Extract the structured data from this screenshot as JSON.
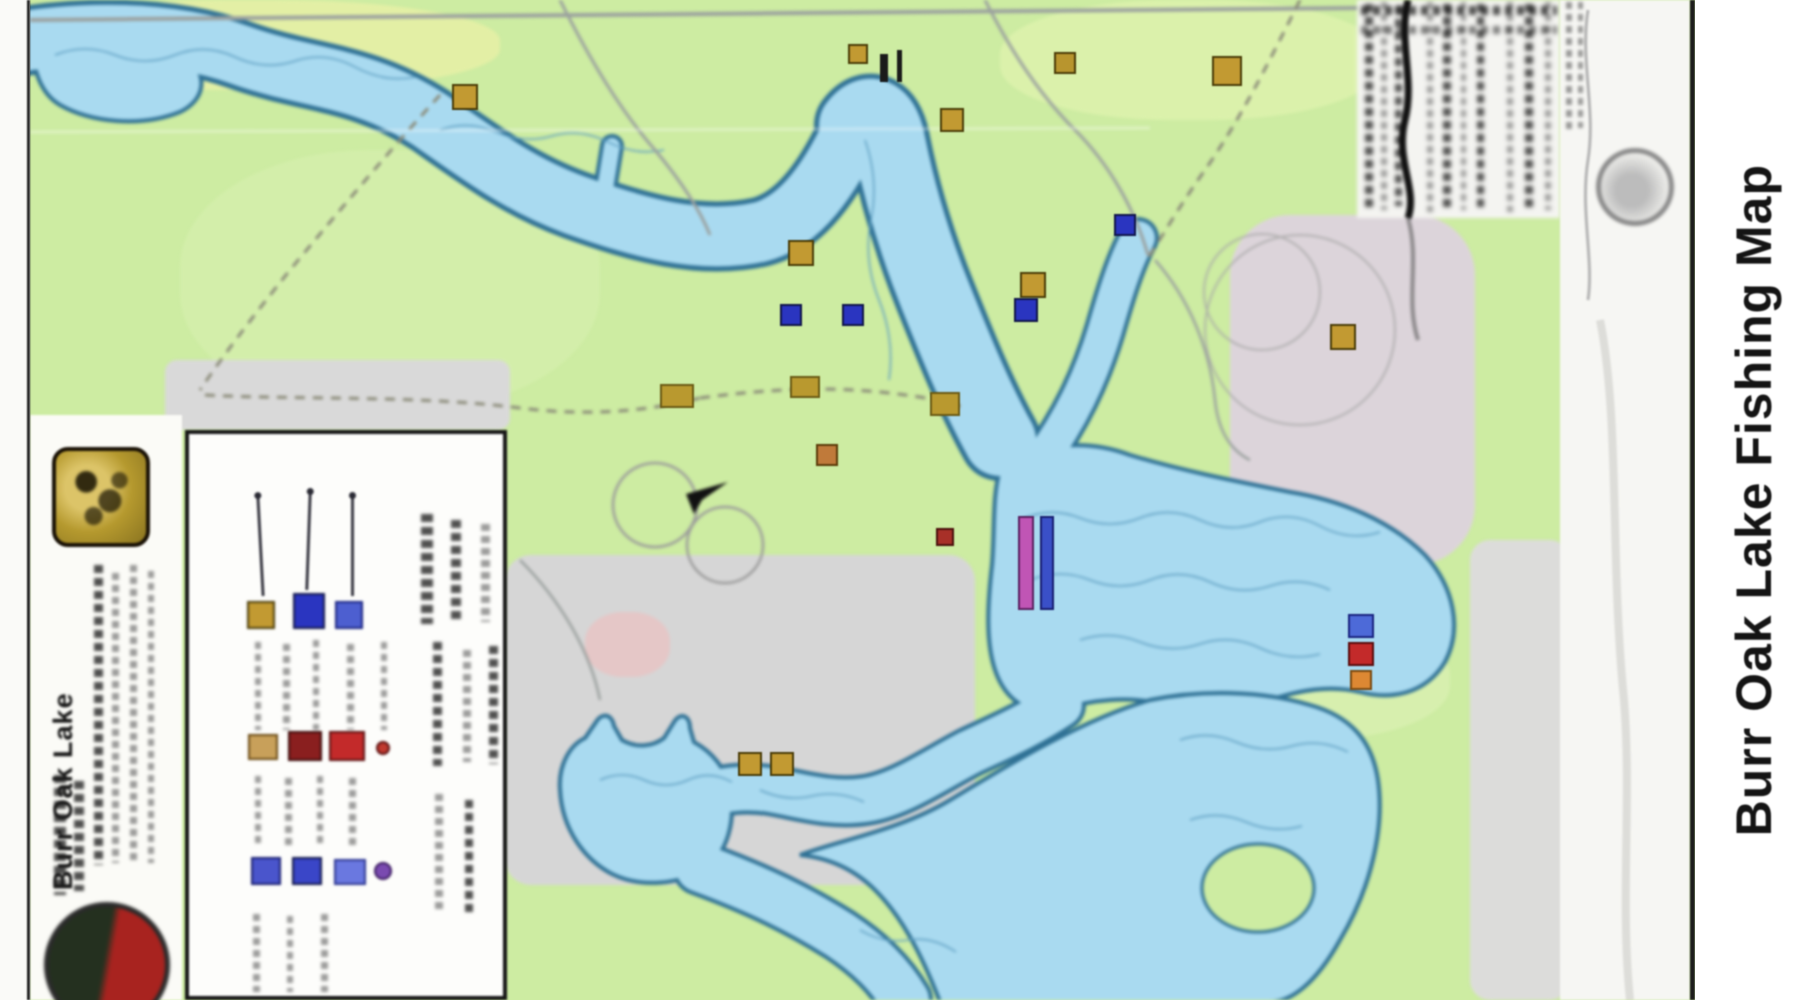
{
  "page": {
    "title": "Burr Oak Lake Fishing Map"
  },
  "right_margin": {
    "title": "Burr Oak Lake Fishing Map"
  },
  "sidebar": {
    "lake_name": "Burr Oak Lake",
    "logos": [
      "gold-park-logo",
      "round-red-green-logo"
    ]
  },
  "colors": {
    "land_green": "#cdeca2",
    "water_fill": "#a9daf0",
    "water_outline": "#2f7195",
    "terrain_gray": "#d6d6d6",
    "panel_white": "#f4f4f1",
    "marker_gold": "#c29a32",
    "marker_navy": "#2a35c0",
    "marker_blue": "#4d6ad8",
    "marker_red": "#c32a2a",
    "marker_orange": "#dd8833",
    "ramp_magenta": "#c055b5",
    "ramp_blue": "#3a50c8"
  },
  "map": {
    "markers": [
      {
        "name": "corner-red-marker",
        "x": 0,
        "y": 4,
        "w": 26,
        "h": 34,
        "color": "#701418",
        "border": "#2a0406"
      },
      {
        "name": "access-marker-gold",
        "x": 452,
        "y": 84,
        "w": 26,
        "h": 26,
        "color": "#c29a32",
        "border": "#4a3c08"
      },
      {
        "name": "access-marker-gold",
        "x": 1212,
        "y": 56,
        "w": 30,
        "h": 30,
        "color": "#c29a32",
        "border": "#4a3c08"
      },
      {
        "name": "black-tick",
        "x": 880,
        "y": 54,
        "w": 8,
        "h": 28,
        "color": "#1a1a1a",
        "border": "transparent"
      },
      {
        "name": "black-tick",
        "x": 897,
        "y": 50,
        "w": 5,
        "h": 32,
        "color": "#1a1a1a",
        "border": "transparent"
      },
      {
        "name": "access-marker-gold",
        "x": 848,
        "y": 44,
        "w": 20,
        "h": 20,
        "color": "#c29a32",
        "border": "#4a3c08"
      },
      {
        "name": "access-marker-gold",
        "x": 940,
        "y": 108,
        "w": 24,
        "h": 24,
        "color": "#c29a32",
        "border": "#4a3c08"
      },
      {
        "name": "access-marker-gold",
        "x": 1054,
        "y": 52,
        "w": 22,
        "h": 22,
        "color": "#b8952e",
        "border": "#4a3c08"
      },
      {
        "name": "access-marker-gold",
        "x": 788,
        "y": 240,
        "w": 26,
        "h": 26,
        "color": "#c29a32",
        "border": "#4a3c08"
      },
      {
        "name": "access-marker-gold",
        "x": 1020,
        "y": 272,
        "w": 26,
        "h": 26,
        "color": "#c29a32",
        "border": "#4a3c08"
      },
      {
        "name": "access-marker-gold",
        "x": 1330,
        "y": 324,
        "w": 26,
        "h": 26,
        "color": "#c29a32",
        "border": "#4a3c08"
      },
      {
        "name": "route-number-blob",
        "x": 660,
        "y": 384,
        "w": 34,
        "h": 24,
        "color": "#b9992f",
        "border": "#6a5a14"
      },
      {
        "name": "route-number-blob",
        "x": 790,
        "y": 376,
        "w": 30,
        "h": 22,
        "color": "#b9992f",
        "border": "#6a5a14"
      },
      {
        "name": "route-number-blob",
        "x": 930,
        "y": 392,
        "w": 30,
        "h": 24,
        "color": "#b9992f",
        "border": "#6a5a14"
      },
      {
        "name": "access-marker-gold",
        "x": 816,
        "y": 444,
        "w": 22,
        "h": 22,
        "color": "#c07a3a",
        "border": "#5a3a08"
      },
      {
        "name": "access-marker-gold",
        "x": 738,
        "y": 752,
        "w": 24,
        "h": 24,
        "color": "#c29a32",
        "border": "#4a3c08"
      },
      {
        "name": "access-marker-gold",
        "x": 770,
        "y": 752,
        "w": 24,
        "h": 24,
        "color": "#c29a32",
        "border": "#4a3c08"
      },
      {
        "name": "fish-marker-navy",
        "x": 780,
        "y": 304,
        "w": 22,
        "h": 22,
        "color": "#2a35c0",
        "border": "#10154a"
      },
      {
        "name": "fish-marker-navy",
        "x": 842,
        "y": 304,
        "w": 22,
        "h": 22,
        "color": "#2a35c0",
        "border": "#10154a"
      },
      {
        "name": "fish-marker-navy",
        "x": 1014,
        "y": 298,
        "w": 24,
        "h": 24,
        "color": "#2a35c0",
        "border": "#10154a"
      },
      {
        "name": "fish-marker-navy",
        "x": 1114,
        "y": 214,
        "w": 22,
        "h": 22,
        "color": "#2a35c0",
        "border": "#10154a"
      },
      {
        "name": "fish-marker-blue",
        "x": 1348,
        "y": 614,
        "w": 26,
        "h": 24,
        "color": "#4d6ad8",
        "border": "#1a2480"
      },
      {
        "name": "fish-marker-red",
        "x": 1348,
        "y": 642,
        "w": 26,
        "h": 24,
        "color": "#c32a2a",
        "border": "#5a0d0d"
      },
      {
        "name": "fish-marker-orange",
        "x": 1350,
        "y": 670,
        "w": 22,
        "h": 20,
        "color": "#dd8833",
        "border": "#7a4a10"
      },
      {
        "name": "boat-ramp-bar-magenta",
        "x": 1018,
        "y": 516,
        "w": 16,
        "h": 94,
        "color": "#c055b5",
        "border": "#5a2060"
      },
      {
        "name": "boat-ramp-bar-blue",
        "x": 1040,
        "y": 516,
        "w": 14,
        "h": 94,
        "color": "#3a50c8",
        "border": "#181e70"
      },
      {
        "name": "small-red-marker",
        "x": 936,
        "y": 528,
        "w": 18,
        "h": 18,
        "color": "#a83028",
        "border": "#4a100c"
      }
    ]
  },
  "legend": {
    "swatches": [
      {
        "name": "legend-swatch-gold",
        "x": 58,
        "y": 167,
        "w": 28,
        "h": 28,
        "color": "#c29a32",
        "border": "#4a3c08"
      },
      {
        "name": "legend-swatch-navy",
        "x": 104,
        "y": 159,
        "w": 32,
        "h": 36,
        "color": "#2a35c0",
        "border": "#10154a"
      },
      {
        "name": "legend-swatch-blue",
        "x": 146,
        "y": 167,
        "w": 28,
        "h": 28,
        "color": "#4d5fd0",
        "border": "#1a2480"
      },
      {
        "name": "legend-swatch-tan",
        "x": 59,
        "y": 300,
        "w": 30,
        "h": 26,
        "color": "#c8a05a",
        "border": "#6a4a14"
      },
      {
        "name": "legend-swatch-darkred",
        "x": 99,
        "y": 297,
        "w": 34,
        "h": 30,
        "color": "#8a1f1f",
        "border": "#3a0808"
      },
      {
        "name": "legend-swatch-red",
        "x": 140,
        "y": 297,
        "w": 36,
        "h": 30,
        "color": "#c32a2a",
        "border": "#5a0d0d"
      },
      {
        "name": "legend-dot-red",
        "x": 187,
        "y": 307,
        "w": 14,
        "h": 14,
        "color": "#c03a30",
        "border": "#5a0d0d",
        "round": true
      },
      {
        "name": "legend-swatch-blue2",
        "x": 62,
        "y": 423,
        "w": 30,
        "h": 28,
        "color": "#4a55cc",
        "border": "#181e70"
      },
      {
        "name": "legend-swatch-navy2",
        "x": 103,
        "y": 423,
        "w": 30,
        "h": 28,
        "color": "#3a46c8",
        "border": "#10154a"
      },
      {
        "name": "legend-swatch-lightblue",
        "x": 145,
        "y": 425,
        "w": 32,
        "h": 26,
        "color": "#6a78e0",
        "border": "#2a3490"
      },
      {
        "name": "legend-dot-purple",
        "x": 185,
        "y": 428,
        "w": 18,
        "h": 18,
        "color": "#7a4ab0",
        "border": "#3a1a60",
        "round": true
      }
    ]
  }
}
